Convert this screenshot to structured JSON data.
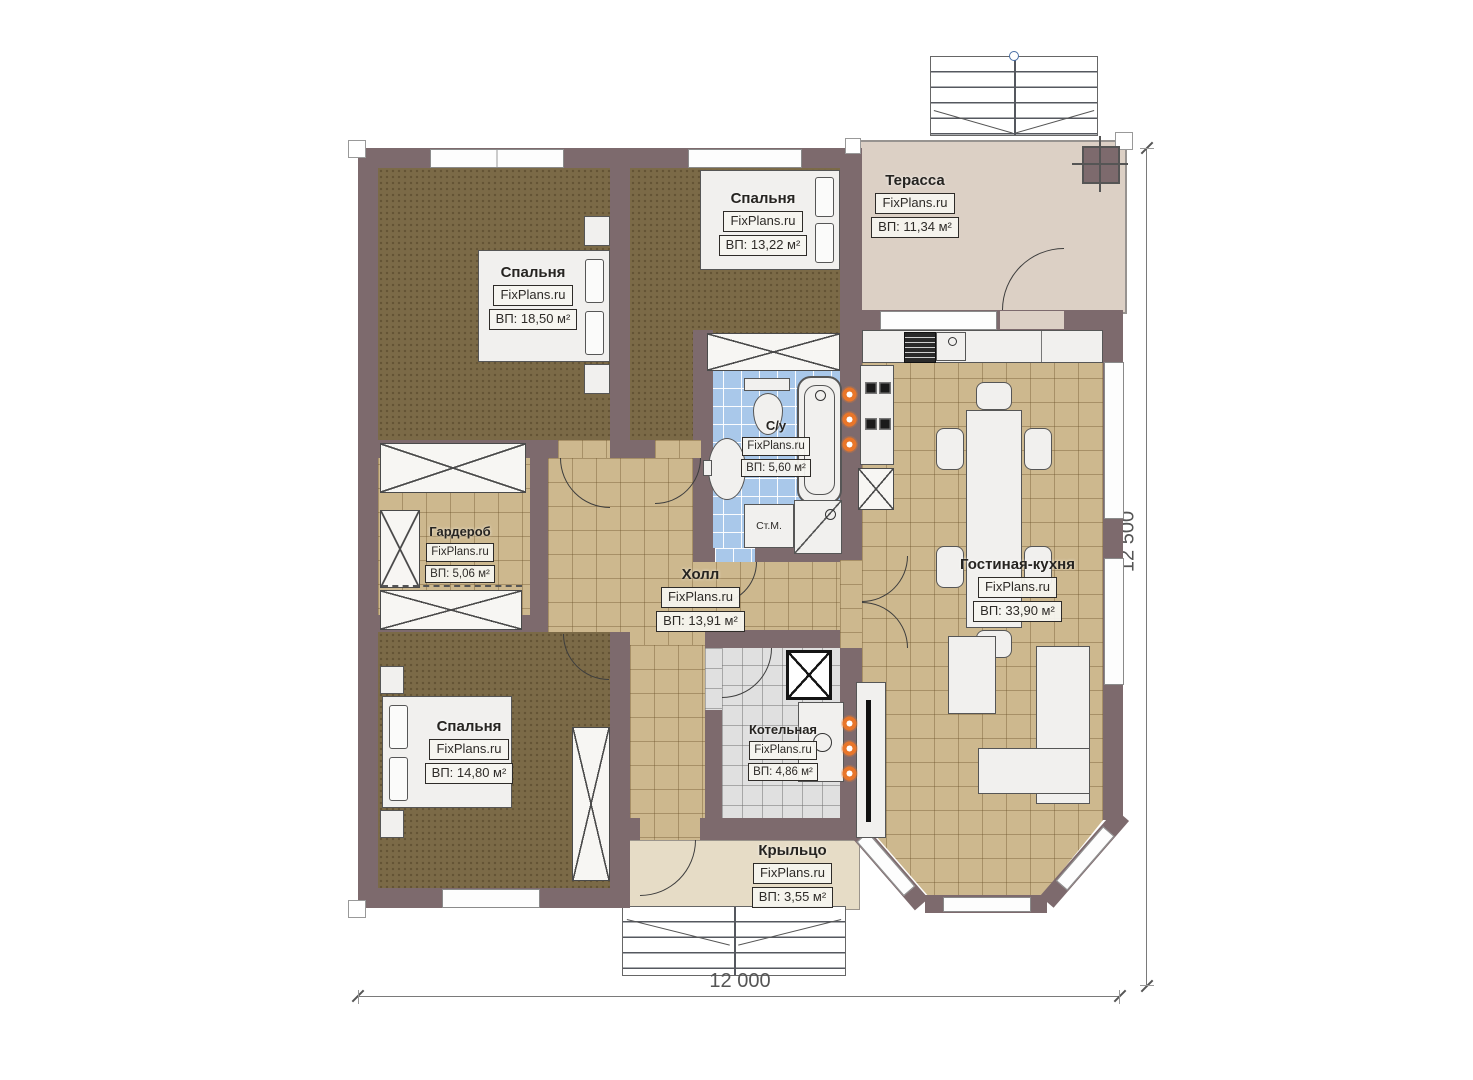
{
  "plan": {
    "rooms": {
      "bedroom1": {
        "name": "Спальня",
        "watermark": "FixPlans.ru",
        "area": "ВП: 18,50 м²"
      },
      "bedroom2": {
        "name": "Спальня",
        "watermark": "FixPlans.ru",
        "area": "ВП: 13,22 м²"
      },
      "terrace": {
        "name": "Терасса",
        "watermark": "FixPlans.ru",
        "area": "ВП: 11,34 м²"
      },
      "bathroom": {
        "name": "С/у",
        "watermark": "FixPlans.ru",
        "area": "ВП: 5,60 м²"
      },
      "wardrobe": {
        "name": "Гардероб",
        "watermark": "FixPlans.ru",
        "area": "ВП: 5,06 м²"
      },
      "hall": {
        "name": "Холл",
        "watermark": "FixPlans.ru",
        "area": "ВП: 13,91 м²"
      },
      "living": {
        "name": "Гостиная-кухня",
        "watermark": "FixPlans.ru",
        "area": "ВП: 33,90 м²"
      },
      "bedroom3": {
        "name": "Спальня",
        "watermark": "FixPlans.ru",
        "area": "ВП: 14,80 м²"
      },
      "boiler": {
        "name": "Котельная",
        "watermark": "FixPlans.ru",
        "area": "ВП: 4,86 м²"
      },
      "porch": {
        "name": "Крыльцо",
        "watermark": "FixPlans.ru",
        "area": "ВП: 3,55 м²"
      }
    },
    "fixtures": {
      "washing_machine": "Ст.М."
    },
    "dimensions": {
      "width": "12 000",
      "height": "12 500"
    },
    "colors": {
      "wall": "#7d6a6d",
      "bedroom_floor": "#7b6a47",
      "tile_beige": "#cdb88e",
      "tile_blue": "#a9c8ea",
      "tile_gray": "#e0e0e0",
      "terrace": "#dcd0c5",
      "porch": "#e6dcc6",
      "radiator": "#e8762a"
    }
  }
}
